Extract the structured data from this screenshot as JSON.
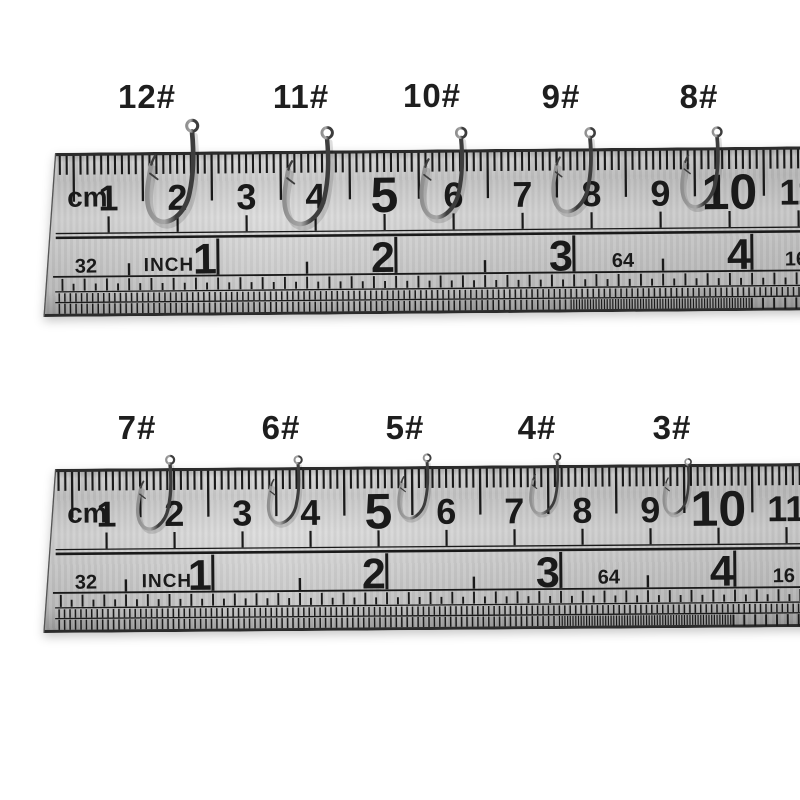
{
  "photo": {
    "background_color": "#ffffff",
    "description": "Ten fishing hooks sized 12# to 3# displayed on two stainless steel rulers"
  },
  "hook_rows": [
    {
      "hooks": [
        {
          "size_label": "12#"
        },
        {
          "size_label": "11#"
        },
        {
          "size_label": "10#"
        },
        {
          "size_label": "9#"
        },
        {
          "size_label": "8#"
        }
      ]
    },
    {
      "hooks": [
        {
          "size_label": "7#"
        },
        {
          "size_label": "6#"
        },
        {
          "size_label": "5#"
        },
        {
          "size_label": "4#"
        },
        {
          "size_label": "3#"
        }
      ]
    }
  ],
  "rulers": [
    {
      "unit_label": "cm",
      "cm_numbers": [
        "1",
        "2",
        "3",
        "4",
        "5",
        "6",
        "7",
        "8",
        "9",
        "10",
        "11"
      ],
      "emphasized_cm_numbers": [
        "5",
        "10"
      ],
      "inch_unit_label": "INCH",
      "inch_numbers": [
        "1",
        "2",
        "3",
        "4"
      ],
      "fraction_scale_labels": {
        "left": "32",
        "mid": "64",
        "right": "16"
      }
    },
    {
      "unit_label": "cm",
      "cm_numbers": [
        "1",
        "2",
        "3",
        "4",
        "5",
        "6",
        "7",
        "8",
        "9",
        "10",
        "11"
      ],
      "emphasized_cm_numbers": [
        "5",
        "10"
      ],
      "inch_unit_label": "INCH",
      "inch_numbers": [
        "1",
        "2",
        "3",
        "4"
      ],
      "fraction_scale_labels": {
        "left": "32",
        "mid": "64",
        "right": "16"
      }
    }
  ],
  "colors": {
    "marking": "#1a1a1a",
    "edge": "#2b2b2b",
    "hook_label_text": "#1e1e1e",
    "hook_metal_dark": "#3d3d3d",
    "hook_metal_mid": "#8f8f8f",
    "hook_metal_light": "#a6a6a6"
  }
}
